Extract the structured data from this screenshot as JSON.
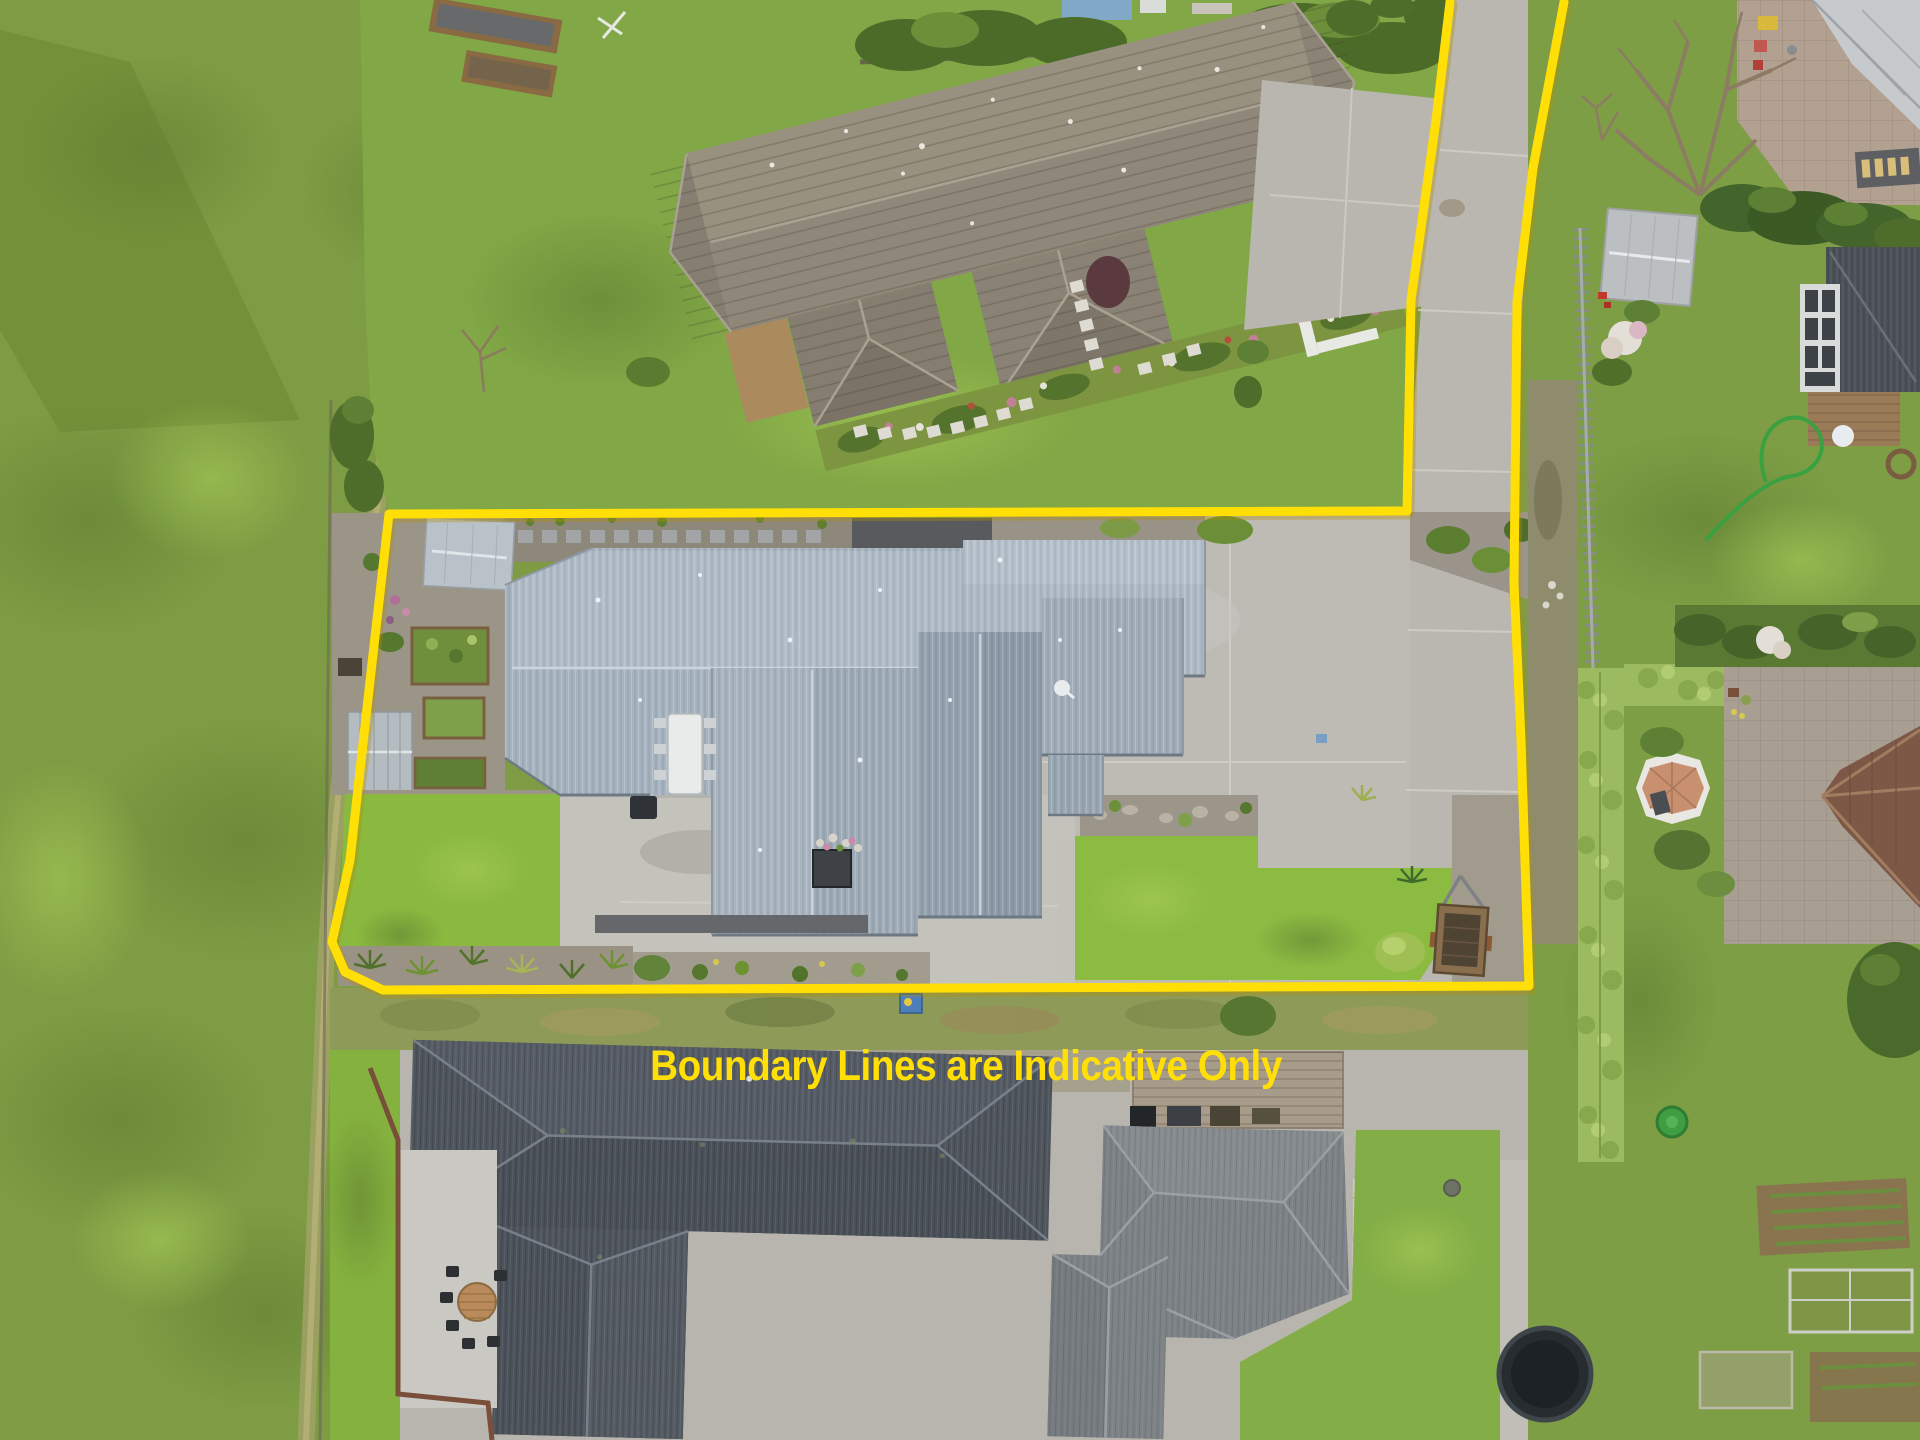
{
  "overlay": {
    "disclaimer_text": "Boundary Lines are Indicative Only",
    "text_color": "#FFDF05",
    "boundary_color": "#FFDF05",
    "boundary_stroke_width": 9,
    "boundary_points": "1450,2 1436,120 1411,300 1407,511 389,514 371,672 350,860 332,942 345,972 383,990 1529,986 1521,740 1514,584 1517,302 1533,168 1564,2"
  },
  "palette": {
    "grass_field": "#7E9C43",
    "lawn_bright": "#8CBB42",
    "concrete": "#B9B7B0",
    "dark_path": "#595A5E",
    "roof_main_house": "#A5B1BD",
    "roof_top_house": "#8F8779",
    "roof_bottom_left_house": "#4F555D",
    "roof_bottom_right_house": "#7D8286",
    "hedge": "#9CBA5F",
    "roof_terracotta": "#7D5847",
    "deck_wood": "#A79B89",
    "garden_gravel": "#9B9588"
  }
}
